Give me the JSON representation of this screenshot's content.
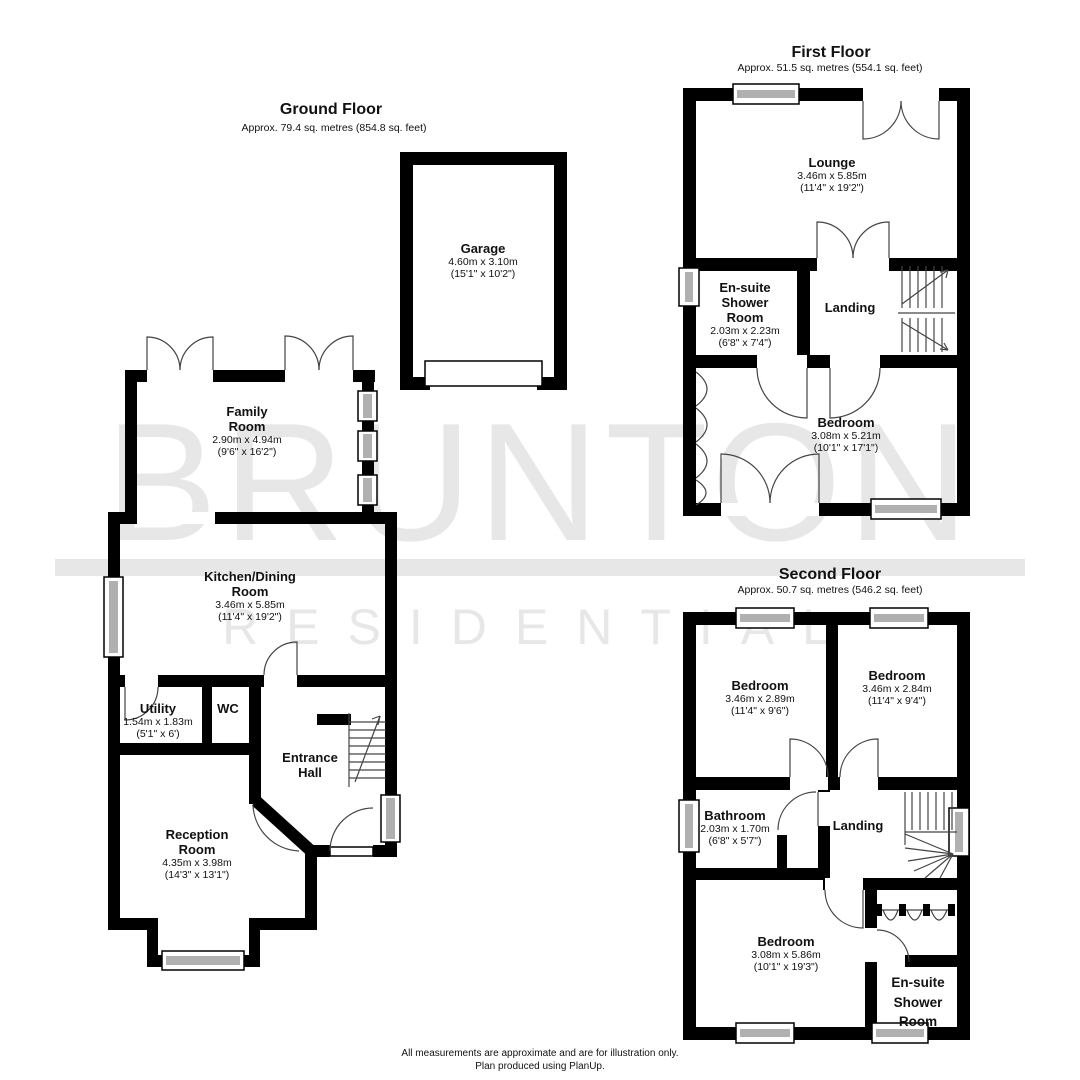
{
  "watermark": {
    "brand": "BRUNTON",
    "brand_sub": "RESIDENTIAL"
  },
  "floors": {
    "ground": {
      "title": "Ground Floor",
      "subtitle": "Approx. 79.4 sq. metres (854.8 sq. feet)"
    },
    "first": {
      "title": "First Floor",
      "subtitle": "Approx. 51.5 sq. metres (554.1 sq. feet)"
    },
    "second": {
      "title": "Second Floor",
      "subtitle": "Approx. 50.7 sq. metres (546.2 sq. feet)"
    }
  },
  "rooms": {
    "garage": {
      "n1": "Garage",
      "metric": "4.60m x 3.10m",
      "imperial": "(15'1\" x 10'2\")"
    },
    "family": {
      "n1": "Family",
      "n2": "Room",
      "metric": "2.90m x 4.94m",
      "imperial": "(9'6\" x 16'2\")"
    },
    "kitchen": {
      "n1": "Kitchen/Dining",
      "n2": "Room",
      "metric": "3.46m x 5.85m",
      "imperial": "(11'4\" x 19'2\")"
    },
    "utility": {
      "n1": "Utility",
      "metric": "1.54m x 1.83m",
      "imperial": "(5'1\" x 6')"
    },
    "wc": {
      "n1": "WC"
    },
    "entrance": {
      "n1": "Entrance",
      "n2": "Hall"
    },
    "reception": {
      "n1": "Reception",
      "n2": "Room",
      "metric": "4.35m x 3.98m",
      "imperial": "(14'3\" x 13'1\")"
    },
    "lounge": {
      "n1": "Lounge",
      "metric": "3.46m x 5.85m",
      "imperial": "(11'4\" x 19'2\")"
    },
    "ensuite1": {
      "n1": "En-suite",
      "n2": "Shower",
      "n3": "Room",
      "metric": "2.03m x 2.23m",
      "imperial": "(6'8\" x 7'4\")"
    },
    "landing1": {
      "n1": "Landing"
    },
    "bedroom1": {
      "n1": "Bedroom",
      "metric": "3.08m x 5.21m",
      "imperial": "(10'1\" x 17'1\")"
    },
    "bedroom2a": {
      "n1": "Bedroom",
      "metric": "3.46m x 2.89m",
      "imperial": "(11'4\" x 9'6\")"
    },
    "bedroom2b": {
      "n1": "Bedroom",
      "metric": "3.46m x 2.84m",
      "imperial": "(11'4\" x 9'4\")"
    },
    "bathroom": {
      "n1": "Bathroom",
      "metric": "2.03m x 1.70m",
      "imperial": "(6'8\" x 5'7\")"
    },
    "landing2": {
      "n1": "Landing"
    },
    "bedroom2c": {
      "n1": "Bedroom",
      "metric": "3.08m x 5.86m",
      "imperial": "(10'1\" x 19'3\")"
    },
    "ensuite2": {
      "n1": "En-suite",
      "n2": "Shower",
      "n3": "Room"
    }
  },
  "footer": {
    "line1": "All measurements are approximate and are for illustration only.",
    "line2": "Plan produced using PlanUp."
  }
}
